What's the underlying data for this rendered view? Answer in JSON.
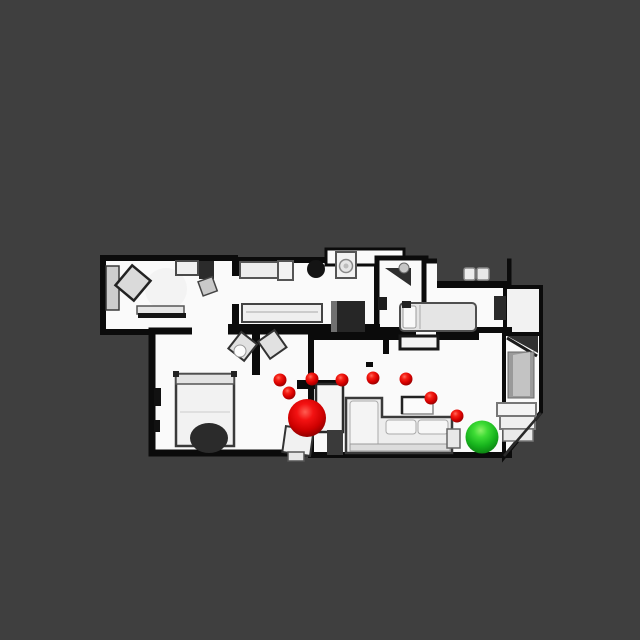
{
  "scene": {
    "kind": "top-down-3d-scan-viewer",
    "background_color": "#3f3f3f",
    "canvas": {
      "width": 640,
      "height": 640
    }
  },
  "markers": {
    "start": {
      "label": "start-position-sphere",
      "color": "#e00000",
      "x": 307,
      "y": 418,
      "r": 19
    },
    "goal": {
      "label": "goal-position-sphere",
      "color": "#27c322",
      "x": 482,
      "y": 437,
      "r": 16.5
    },
    "waypoints": {
      "label": "path-waypoint-spheres",
      "color": "#e00000",
      "r": 6.5,
      "points": [
        [
          280,
          380
        ],
        [
          289,
          393
        ],
        [
          312,
          379
        ],
        [
          342,
          380
        ],
        [
          373,
          378
        ],
        [
          406,
          379
        ],
        [
          431,
          398
        ],
        [
          457,
          416
        ]
      ]
    }
  },
  "floorplan": {
    "colors": {
      "floor": "#fafafa",
      "wall": "#0b0b0b",
      "background": "#3f3f3f"
    },
    "shapes": [
      {
        "n": "room-topleft-floor",
        "t": "rect",
        "x": 103,
        "y": 258,
        "w": 132,
        "h": 74,
        "f": "floor",
        "s": "wall",
        "sw": 6
      },
      {
        "n": "room-bottomleft-floor",
        "t": "rect",
        "x": 152,
        "y": 331,
        "w": 160,
        "h": 122,
        "f": "floor",
        "s": "wall",
        "sw": 7
      },
      {
        "n": "room-kitchen-floor",
        "t": "rect",
        "x": 236,
        "y": 260,
        "w": 141,
        "h": 71,
        "f": "floor",
        "s": "wall",
        "sw": 6
      },
      {
        "n": "laundry-nook-floor",
        "t": "rect",
        "x": 326,
        "y": 249,
        "w": 78,
        "h": 16,
        "f": "floor",
        "s": "wall",
        "sw": 3
      },
      {
        "n": "room-corridor-floor",
        "t": "rect",
        "x": 377,
        "y": 258,
        "w": 49,
        "h": 78,
        "f": "floor",
        "s": "wall",
        "sw": 5
      },
      {
        "n": "room-bedroom-right-floor",
        "t": "rect",
        "x": 424,
        "y": 261,
        "w": 85,
        "h": 78,
        "f": "floor",
        "s": "wall",
        "sw": 5
      },
      {
        "n": "nook-topright-floor",
        "t": "rect",
        "x": 505,
        "y": 287,
        "w": 36,
        "h": 57,
        "f": "#f2f2f2",
        "s": "wall",
        "sw": 4
      },
      {
        "n": "room-living-floor",
        "t": "rect",
        "x": 311,
        "y": 330,
        "w": 198,
        "h": 125,
        "f": "floor",
        "s": "wall",
        "sw": 6
      },
      {
        "n": "hallway-stairs-floor",
        "t": "poly",
        "pts": "504,334 541,334 541,412 504,457",
        "f": "floor",
        "s": "wall",
        "sw": 4
      },
      {
        "n": "bedroom-top-cutout",
        "t": "rect",
        "x": 437,
        "y": 254,
        "w": 70,
        "h": 27,
        "f": "#3f3f3f"
      },
      {
        "n": "bedroom-top-wall",
        "t": "rect",
        "x": 437,
        "y": 281,
        "w": 74,
        "h": 7,
        "f": "wall"
      },
      {
        "n": "stool",
        "t": "rect",
        "x": 464,
        "y": 268,
        "w": 11,
        "h": 12,
        "rx": 2,
        "f": "#ececec",
        "s": "#8a8a8a",
        "sw": 1.5
      },
      {
        "n": "stool",
        "t": "rect",
        "x": 477,
        "y": 268,
        "w": 12,
        "h": 12,
        "rx": 2,
        "f": "#e7e7e7",
        "s": "#8a8a8a",
        "sw": 1.5
      },
      {
        "n": "kitchen-bottom-wall",
        "t": "rect",
        "x": 228,
        "y": 324,
        "w": 152,
        "h": 9,
        "f": "wall"
      },
      {
        "n": "door-gap",
        "t": "rect",
        "x": 192,
        "y": 326,
        "w": 36,
        "h": 11,
        "f": "floor"
      },
      {
        "n": "living-top-wall",
        "t": "rect",
        "x": 312,
        "y": 331,
        "w": 167,
        "h": 9,
        "f": "wall"
      },
      {
        "n": "door-gap",
        "t": "rect",
        "x": 416,
        "y": 331,
        "w": 20,
        "h": 9,
        "f": "floor"
      },
      {
        "n": "door-gap",
        "t": "rect",
        "x": 230,
        "y": 276,
        "w": 11,
        "h": 28,
        "f": "floor"
      },
      {
        "n": "partition-stub-wall",
        "t": "rect",
        "x": 252,
        "y": 331,
        "w": 8,
        "h": 44,
        "f": "wall"
      },
      {
        "n": "closet-top-wall",
        "t": "rect",
        "x": 297,
        "y": 380,
        "w": 47,
        "h": 9,
        "f": "wall"
      },
      {
        "n": "doorway-stub-wall",
        "t": "rect",
        "x": 303,
        "y": 434,
        "w": 11,
        "h": 20,
        "f": "wall"
      },
      {
        "n": "column-blob",
        "t": "circle",
        "cx": 316,
        "cy": 269,
        "r": 9,
        "f": "#141414"
      },
      {
        "n": "doorframe-mark",
        "t": "rect",
        "x": 383,
        "y": 335,
        "w": 6,
        "h": 19,
        "f": "wall"
      },
      {
        "n": "floor-mark",
        "t": "rect",
        "x": 366,
        "y": 362,
        "w": 7,
        "h": 5,
        "f": "wall"
      },
      {
        "n": "floor-mark",
        "t": "rect",
        "x": 464,
        "y": 332,
        "w": 11,
        "h": 7,
        "f": "wall"
      },
      {
        "n": "desk",
        "t": "rect",
        "x": 106,
        "y": 266,
        "w": 13,
        "h": 44,
        "f": "#cdcdcd",
        "s": "#3a3a3a",
        "sw": 1.5
      },
      {
        "n": "rug",
        "t": "circle",
        "cx": 166,
        "cy": 289,
        "r": 21,
        "f": "#f3f3f3"
      },
      {
        "n": "chair",
        "t": "rect",
        "x": 121,
        "y": 270,
        "w": 24,
        "h": 26,
        "rot": "40 133 283",
        "f": "#dadada",
        "s": "#222222",
        "sw": 2.5
      },
      {
        "n": "cabinet",
        "t": "rect",
        "x": 176,
        "y": 261,
        "w": 22,
        "h": 14,
        "f": "#efefef",
        "s": "#4a4a4a",
        "sw": 2
      },
      {
        "n": "dark-cabinet",
        "t": "rect",
        "x": 199,
        "y": 261,
        "w": 15,
        "h": 18,
        "f": "#2b2b2b"
      },
      {
        "n": "chair",
        "t": "rect",
        "x": 200,
        "y": 279,
        "w": 15,
        "h": 15,
        "rot": "-20 207 286",
        "f": "#c9c9c9",
        "s": "#444444",
        "sw": 1.5
      },
      {
        "n": "shelf",
        "t": "rect",
        "x": 137,
        "y": 306,
        "w": 47,
        "h": 8,
        "f": "#e6e6e6",
        "s": "#555555",
        "sw": 1.5
      },
      {
        "n": "shelf-shadow",
        "t": "rect",
        "x": 138,
        "y": 313,
        "w": 48,
        "h": 5,
        "f": "#151515"
      },
      {
        "n": "counter",
        "t": "rect",
        "x": 240,
        "y": 262,
        "w": 40,
        "h": 16,
        "f": "#ececec",
        "s": "#555555",
        "sw": 2
      },
      {
        "n": "cabinet",
        "t": "rect",
        "x": 278,
        "y": 261,
        "w": 15,
        "h": 19,
        "f": "#f2f2f2",
        "s": "#555555",
        "sw": 2
      },
      {
        "n": "kitchen-island",
        "t": "rect",
        "x": 242,
        "y": 304,
        "w": 80,
        "h": 18,
        "f": "#efefef",
        "s": "#444444",
        "sw": 2
      },
      {
        "n": "island-line",
        "t": "line",
        "x1": 246,
        "y1": 312,
        "x2": 318,
        "y2": 312,
        "s": "#c0c0c0",
        "sw": 1.5
      },
      {
        "n": "fridge-block",
        "t": "rect",
        "x": 331,
        "y": 301,
        "w": 34,
        "h": 31,
        "f": "#262626"
      },
      {
        "n": "fridge-edge",
        "t": "rect",
        "x": 331,
        "y": 301,
        "w": 6,
        "h": 31,
        "f": "#707070"
      },
      {
        "n": "washing-machine",
        "t": "rect",
        "x": 336,
        "y": 252,
        "w": 20,
        "h": 26,
        "f": "#f2f2f2",
        "s": "#555555",
        "sw": 2
      },
      {
        "n": "washer-drum",
        "t": "circle",
        "cx": 346,
        "cy": 266,
        "r": 6.5,
        "f": "#e6e6e6",
        "s": "#8a8a8a",
        "sw": 1.5
      },
      {
        "n": "washer-core",
        "t": "circle",
        "cx": 346,
        "cy": 266,
        "r": 2.5,
        "f": "#bdbdbd"
      },
      {
        "n": "open-door-wedge",
        "t": "poly",
        "pts": "385,268 411,286 411,268",
        "f": "#2e2e2e"
      },
      {
        "n": "sink",
        "t": "circle",
        "cx": 404,
        "cy": 268,
        "r": 5,
        "f": "#c6c6c6",
        "s": "#666666",
        "sw": 1
      },
      {
        "n": "dark-fixture",
        "t": "rect",
        "x": 378,
        "y": 297,
        "w": 9,
        "h": 13,
        "f": "#1d1d1d"
      },
      {
        "n": "bed",
        "t": "rect",
        "x": 400,
        "y": 303,
        "w": 76,
        "h": 28,
        "rx": 4,
        "f": "#e5e5e5",
        "s": "#4f4f4f",
        "sw": 2
      },
      {
        "n": "pillow",
        "t": "rect",
        "x": 403,
        "y": 306,
        "w": 13,
        "h": 22,
        "rx": 2,
        "f": "#f9f9f9",
        "s": "#9a9a9a",
        "sw": 1
      },
      {
        "n": "bed-line",
        "t": "line",
        "x1": 420,
        "y1": 305,
        "x2": 420,
        "y2": 329,
        "s": "#bdbdbd",
        "sw": 1.5
      },
      {
        "n": "bed-corner-mark",
        "t": "rect",
        "x": 402,
        "y": 301,
        "w": 9,
        "h": 7,
        "f": "#222222"
      },
      {
        "n": "wardrobe-dark",
        "t": "rect",
        "x": 494,
        "y": 296,
        "w": 12,
        "h": 24,
        "f": "#2a2a2a"
      },
      {
        "n": "open-door-dark",
        "t": "poly",
        "pts": "507,336 538,336 538,353",
        "f": "#303030"
      },
      {
        "n": "open-door-line",
        "t": "line",
        "x1": 507,
        "y1": 338,
        "x2": 537,
        "y2": 356,
        "s": "#1a1a1a",
        "sw": 3
      },
      {
        "n": "stairwell-gray",
        "t": "rect",
        "x": 508,
        "y": 352,
        "w": 26,
        "h": 46,
        "f": "#9a9a9a",
        "s": "#6a6a6a",
        "sw": 1
      },
      {
        "n": "stairwell-light",
        "t": "poly",
        "pts": "513,355 530,352 530,396 513,396",
        "f": "#c3c3c3"
      },
      {
        "n": "stair-step",
        "t": "rect",
        "x": 497,
        "y": 403,
        "w": 39,
        "h": 13,
        "f": "#f4f4f4",
        "s": "#777777",
        "sw": 2
      },
      {
        "n": "stair-step",
        "t": "rect",
        "x": 500,
        "y": 416,
        "w": 35,
        "h": 13,
        "f": "#efefef",
        "s": "#777777",
        "sw": 2
      },
      {
        "n": "stair-step",
        "t": "rect",
        "x": 503,
        "y": 429,
        "w": 30,
        "h": 12,
        "f": "#eaeaea",
        "s": "#777777",
        "sw": 1.5
      },
      {
        "n": "stair-diagonal",
        "t": "line",
        "x1": 504,
        "y1": 456,
        "x2": 541,
        "y2": 413,
        "s": "#2a2a2a",
        "sw": 2.5
      },
      {
        "n": "bed",
        "t": "rect",
        "x": 176,
        "y": 374,
        "w": 58,
        "h": 72,
        "f": "#f2f2f2",
        "s": "#3a3a3a",
        "sw": 2.5
      },
      {
        "n": "headboard",
        "t": "rect",
        "x": 176,
        "y": 374,
        "w": 58,
        "h": 10,
        "f": "#e3e3e3",
        "s": "#555555",
        "sw": 1.5
      },
      {
        "n": "bed-line",
        "t": "line",
        "x1": 180,
        "y1": 412,
        "x2": 230,
        "y2": 412,
        "s": "#cccccc",
        "sw": 1
      },
      {
        "n": "bedpost",
        "t": "rect",
        "x": 173,
        "y": 371,
        "w": 6,
        "h": 6,
        "f": "#222222"
      },
      {
        "n": "bedpost",
        "t": "rect",
        "x": 231,
        "y": 371,
        "w": 6,
        "h": 6,
        "f": "#222222"
      },
      {
        "n": "duvet-dark",
        "t": "ellipse",
        "cx": 209,
        "cy": 438,
        "rx": 19,
        "ry": 15,
        "f": "#2b2b2b"
      },
      {
        "n": "chair",
        "t": "rect",
        "x": 233,
        "y": 336,
        "w": 20,
        "h": 21,
        "rot": "38 243 346",
        "f": "#e1e1e1",
        "s": "#333333",
        "sw": 2
      },
      {
        "n": "chair",
        "t": "rect",
        "x": 262,
        "y": 334,
        "w": 20,
        "h": 21,
        "rot": "-35 272 344",
        "f": "#e1e1e1",
        "s": "#333333",
        "sw": 2
      },
      {
        "n": "cushion",
        "t": "circle",
        "cx": 240,
        "cy": 351,
        "r": 6,
        "f": "#fdfdfd",
        "s": "#999999",
        "sw": 1
      },
      {
        "n": "wall-mark",
        "t": "rect",
        "x": 154,
        "y": 388,
        "w": 7,
        "h": 18,
        "f": "#111111"
      },
      {
        "n": "wall-mark",
        "t": "rect",
        "x": 154,
        "y": 420,
        "w": 6,
        "h": 12,
        "f": "#111111"
      },
      {
        "n": "armchair",
        "t": "rect",
        "x": 284,
        "y": 428,
        "w": 28,
        "h": 26,
        "rot": "8 298 441",
        "f": "#f1f1f1",
        "s": "#333333",
        "sw": 2
      },
      {
        "n": "armchair-foot",
        "t": "rect",
        "x": 288,
        "y": 452,
        "w": 16,
        "h": 9,
        "f": "#e6e6e6",
        "s": "#555555",
        "sw": 1.5
      },
      {
        "n": "tv-console",
        "t": "rect",
        "x": 400,
        "y": 336,
        "w": 38,
        "h": 13,
        "f": "#f3f3f3",
        "s": "#161616",
        "sw": 3
      },
      {
        "n": "closet",
        "t": "rect",
        "x": 316,
        "y": 384,
        "w": 27,
        "h": 48,
        "f": "#f5f5f5",
        "s": "#2a2a2a",
        "sw": 2.5
      },
      {
        "n": "closet-shadow",
        "t": "rect",
        "x": 327,
        "y": 430,
        "w": 16,
        "h": 25,
        "f": "#3a3a3a"
      },
      {
        "n": "coffee-table",
        "t": "rect",
        "x": 402,
        "y": 397,
        "w": 31,
        "h": 17,
        "f": "#fbfbfb",
        "s": "#8a8a8a",
        "sw": 1.5
      },
      {
        "n": "coffee-table-edge",
        "t": "path",
        "d": "M402,414 L402,397 L433,397",
        "s": "#222222",
        "sw": 2.5
      },
      {
        "n": "sofa",
        "t": "poly",
        "pts": "346,398 382,398 382,417 452,417 452,453 346,453",
        "f": "#ededed",
        "s": "#3a3a3a",
        "sw": 2.5
      },
      {
        "n": "sofa-cushion",
        "t": "rect",
        "x": 386,
        "y": 420,
        "w": 30,
        "h": 14,
        "rx": 3,
        "f": "#f7f7f7",
        "s": "#aaaaaa",
        "sw": 1
      },
      {
        "n": "sofa-cushion",
        "t": "rect",
        "x": 418,
        "y": 420,
        "w": 30,
        "h": 14,
        "rx": 3,
        "f": "#f7f7f7",
        "s": "#aaaaaa",
        "sw": 1
      },
      {
        "n": "sofa-chaise",
        "t": "rect",
        "x": 350,
        "y": 401,
        "w": 28,
        "h": 46,
        "rx": 3,
        "f": "#f4f4f4",
        "s": "#aaaaaa",
        "sw": 1
      },
      {
        "n": "sofa-back",
        "t": "rect",
        "x": 350,
        "y": 444,
        "w": 100,
        "h": 7,
        "f": "#dcdcdc",
        "s": "#9a9a9a",
        "sw": 1
      },
      {
        "n": "side-table",
        "t": "rect",
        "x": 447,
        "y": 429,
        "w": 13,
        "h": 19,
        "f": "#e8e8e8",
        "s": "#666666",
        "sw": 1.5
      }
    ]
  }
}
